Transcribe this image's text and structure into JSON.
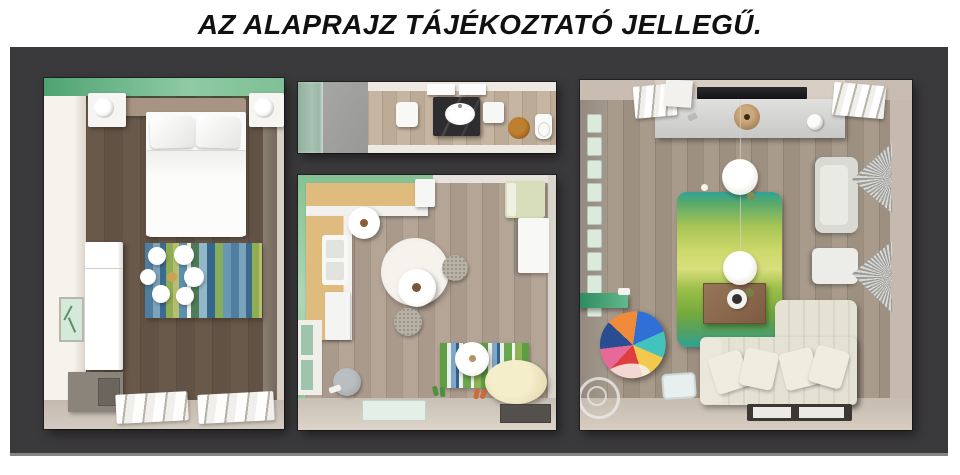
{
  "title": "AZ ALAPRAJZ TÁJÉKOZTATÓ JELLEGŰ.",
  "page": {
    "background": "#ffffff",
    "title_color": "#111111"
  },
  "panel": {
    "background": "#3a393b",
    "bottom_edge": "#848484"
  },
  "palette": {
    "bedroom_accent_wall": "#5fb083",
    "kitchen_accent_green": "#86c293",
    "wood_floor_bedroom": "#a2958a",
    "wood_floor_bathroom": "#c3b29e",
    "wood_floor_kitchen": "#b0a193",
    "wood_floor_living": "#a59889",
    "vanity_stone_dark": "#2d2d2f",
    "bathroom_rug_orange": "#bf7f30",
    "living_shelf_green": "#35966b",
    "living_rug_teal": "#2ea396",
    "living_rug_lime": "#cdd96a",
    "living_rug_green": "#76ab3c",
    "counter_wood": "#dfbc7e"
  },
  "rooms": [
    {
      "id": "bedroom",
      "furniture": [
        "double-bed",
        "pillows",
        "headboard",
        "nightstand-left",
        "nightstand-right",
        "table-lamps",
        "wardrobe",
        "striped-rug",
        "ceiling-chandelier",
        "picture-frame",
        "bench",
        "radiators"
      ]
    },
    {
      "id": "bathroom",
      "furniture": [
        "shower",
        "washing-machine",
        "vanity",
        "sink",
        "cabinet",
        "toilet",
        "round-rug",
        "towel-shelves"
      ]
    },
    {
      "id": "kitchen-dining",
      "furniture": [
        "l-shaped-counter",
        "fridge",
        "sink-unit",
        "appliance",
        "small-round-table",
        "large-round-table",
        "round-area-rug",
        "dining-chairs",
        "daybed",
        "white-cabinet",
        "window",
        "grey-chair",
        "striped-rug",
        "floor-lamp",
        "slippers",
        "pouf",
        "door-mat-mint",
        "door-mat-dark"
      ]
    },
    {
      "id": "living-room",
      "furniture": [
        "tv",
        "sideboard",
        "wood-drum-decor",
        "vase",
        "radiators",
        "storage-cube",
        "pendant-lamps",
        "green-rug",
        "coffee-table",
        "decor-bowl",
        "corner-sofa",
        "sofa-pillows",
        "armchair",
        "ottoman",
        "curtains",
        "patchwork-armchair",
        "glass-side-table",
        "tray-table",
        "wall-shelf-green",
        "picture-frames",
        "glazed-door"
      ]
    }
  ]
}
